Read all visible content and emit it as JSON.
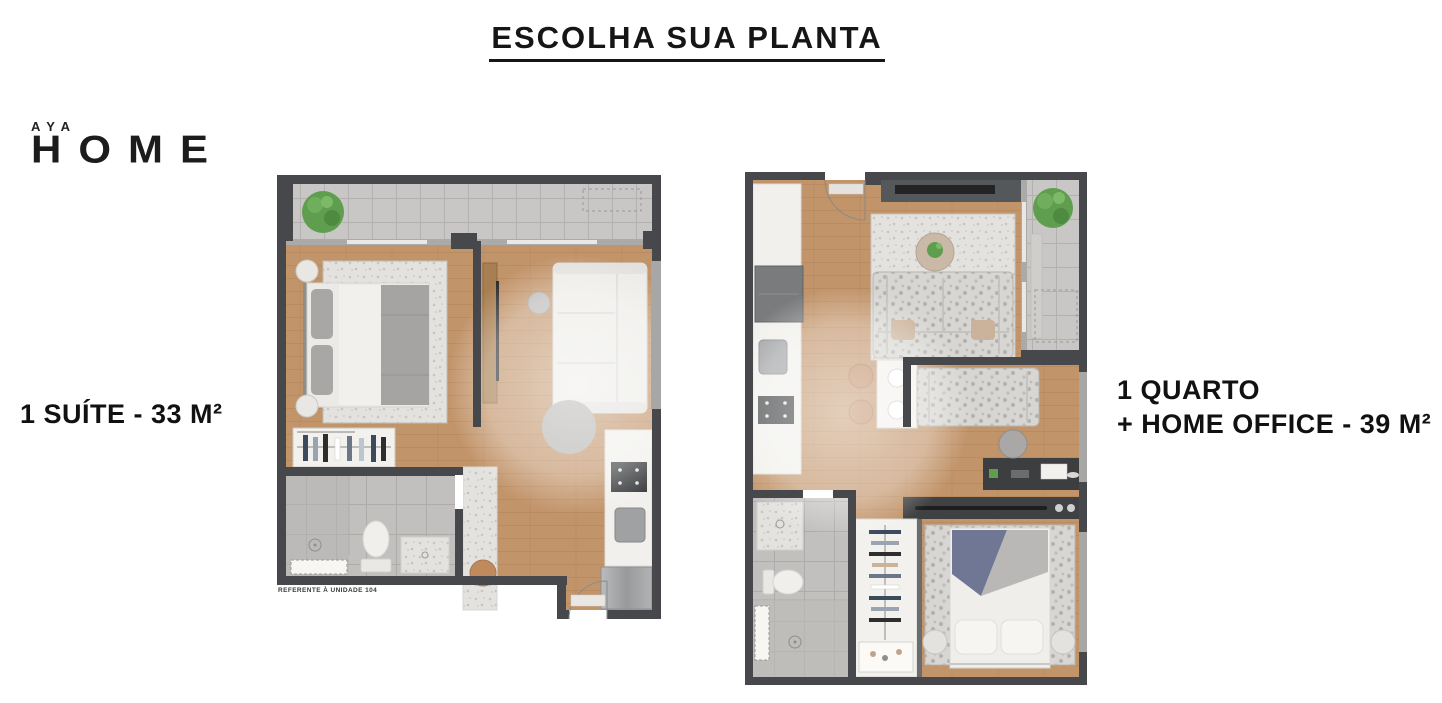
{
  "header": {
    "title": "ESCOLHA SUA PLANTA"
  },
  "logo": {
    "brand_top": "AYA",
    "brand_main": "HOME"
  },
  "plans": [
    {
      "name": "plan-1-suite",
      "label": "1 SUÍTE - 33 M²",
      "caption": "REFERENTE À UNIDADE 104"
    },
    {
      "name": "plan-1-quarto-home-office",
      "label_line1": "1 QUARTO",
      "label_line2": "+ HOME OFFICE - 39 M²"
    }
  ],
  "colors": {
    "text": "#161616",
    "wall_dark": "#46484b",
    "wall_light": "#9c9c9a",
    "wood_floor": "#c2946a",
    "balcony_tile": "#c8c7c5",
    "bathroom_tile": "#c2c0be",
    "rug_light": "#e3e2de",
    "counter_white": "#f1f0ec",
    "appliance_gray": "#9fa1a3",
    "plant_green": "#5f9e4e",
    "accent_tan": "#bf8a61",
    "bed_blue": "#6f7795"
  }
}
